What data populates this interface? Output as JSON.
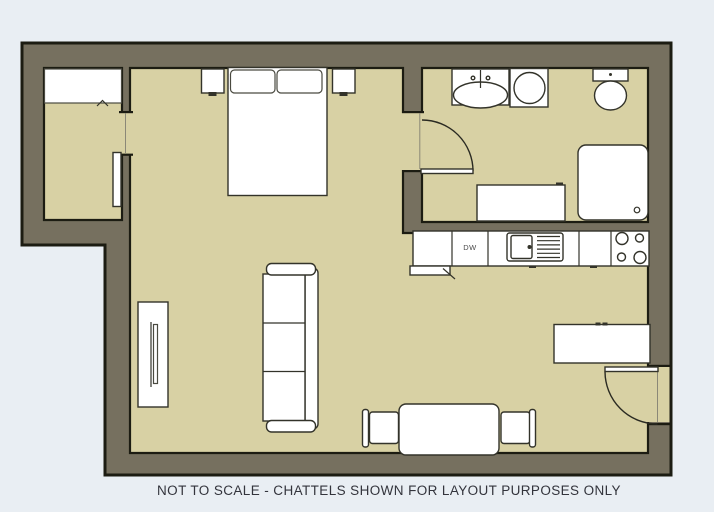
{
  "caption": "NOT TO SCALE - CHATTELS SHOWN FOR LAYOUT PURPOSES ONLY",
  "kitchen": {
    "dishwasher_label": "DW"
  },
  "colors": {
    "background": "#e9eef3",
    "wall_fill": "#76705f",
    "wall_outline": "#1c1c12",
    "floor": "#d8d1a4",
    "furniture_fill": "#ffffff",
    "furniture_outline": "#33332a",
    "caption_text": "#33343c"
  }
}
